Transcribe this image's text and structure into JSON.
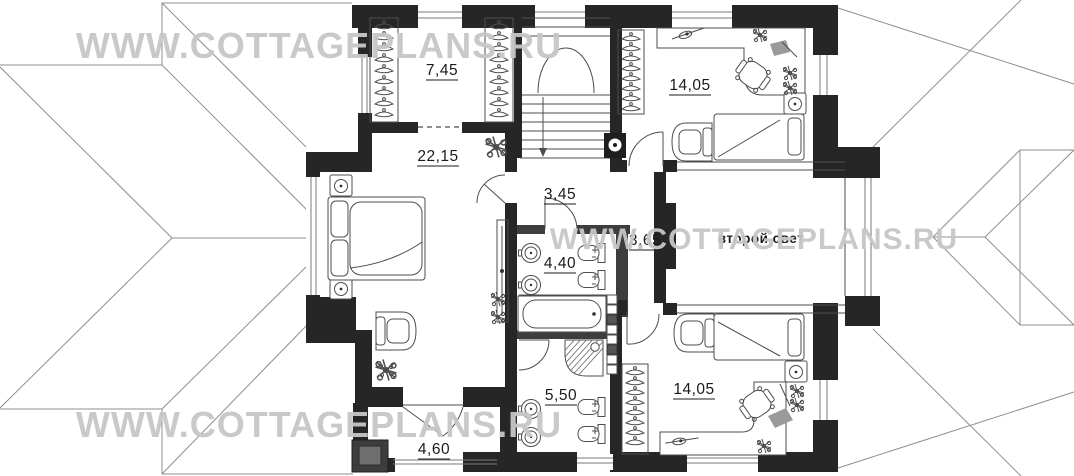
{
  "watermark": {
    "text": "WWW.COTTAGEPLANS.RU",
    "color": "#c7c7c7"
  },
  "plan": {
    "title": "Cottage second floor plan",
    "labels": {
      "closet": "7,45",
      "bedroom_top": "14,05",
      "master_bedroom": "22,15",
      "hall": "3,45",
      "corridor": "3,65",
      "bathroom": "4,40",
      "shower_room": "5,50",
      "bedroom_bottom": "14,05",
      "balcony": "4,60",
      "double_height": "второй свет"
    },
    "colors": {
      "wall": "#262626",
      "roof_line": "#8f8f8f",
      "label_text": "#1b1b1b"
    }
  }
}
